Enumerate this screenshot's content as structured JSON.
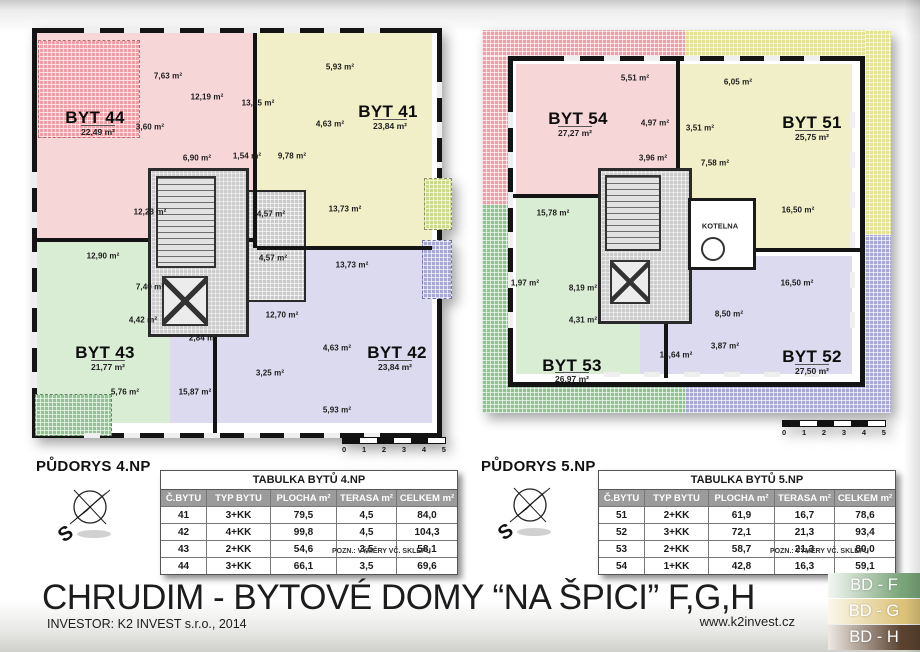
{
  "plans": [
    {
      "title": "PŮDORYS 4.NP",
      "apartments": [
        {
          "name": "BYT 44",
          "area": "22,49 m²"
        },
        {
          "name": "BYT 41",
          "area": "23,84 m²"
        },
        {
          "name": "BYT 43",
          "area": "21,77 m²"
        },
        {
          "name": "BYT 42",
          "area": "23,84 m²"
        }
      ],
      "rooms": [
        "7,63 m²",
        "12,19 m²",
        "13,25 m²",
        "5,93 m²",
        "4,63 m²",
        "3,60 m²",
        "6,90 m²",
        "1,54 m²",
        "9,78 m²",
        "12,23 m²",
        "4,57 m²",
        "13,73 m²",
        "12,90 m²",
        "13,73 m²",
        "4,57 m²",
        "7,40 m²",
        "4,42 m²",
        "12,70 m²",
        "2,84 m²",
        "4,63 m²",
        "3,25 m²",
        "5,76 m²",
        "15,87 m²",
        "5,93 m²"
      ]
    },
    {
      "title": "PŮDORYS 5.NP",
      "apartments": [
        {
          "name": "BYT 54",
          "area": "27,27 m²"
        },
        {
          "name": "BYT 51",
          "area": "25,75 m²"
        },
        {
          "name": "BYT 53",
          "area": "26,97 m²"
        },
        {
          "name": "BYT 52",
          "area": "27,50 m²"
        }
      ],
      "rooms": [
        "5,51 m²",
        "6,05 m²",
        "4,97 m²",
        "3,96 m²",
        "3,51 m²",
        "7,58 m²",
        "15,78 m²",
        "16,50 m²",
        "1,97 m²",
        "8,19 m²",
        "4,31 m²",
        "16,50 m²",
        "8,50 m²",
        "13,64 m²",
        "3,87 m²"
      ],
      "boiler_room": "KOTELNA"
    }
  ],
  "compass": {
    "south": "S"
  },
  "scalebar": [
    "0",
    "1",
    "2",
    "3",
    "4",
    "5"
  ],
  "tables": [
    {
      "title": "TABULKA BYTŮ 4.NP",
      "headers": [
        "Č.BYTU",
        "TYP BYTU",
        "PLOCHA m²",
        "TERASA m²",
        "CELKEM m²"
      ],
      "rows": [
        [
          "41",
          "3+KK",
          "79,5",
          "4,5",
          "84,0"
        ],
        [
          "42",
          "4+KK",
          "99,8",
          "4,5",
          "104,3"
        ],
        [
          "43",
          "2+KK",
          "54,6",
          "3,5",
          "58,1"
        ],
        [
          "44",
          "3+KK",
          "66,1",
          "3,5",
          "69,6"
        ]
      ],
      "note": "POZN.: VÝMĚRY VČ. SKLEPU"
    },
    {
      "title": "TABULKA BYTŮ 5.NP",
      "headers": [
        "Č.BYTU",
        "TYP BYTU",
        "PLOCHA m²",
        "TERASA m²",
        "CELKEM m²"
      ],
      "rows": [
        [
          "51",
          "2+KK",
          "61,9",
          "16,7",
          "78,6"
        ],
        [
          "52",
          "3+KK",
          "72,1",
          "21,3",
          "93,4"
        ],
        [
          "53",
          "2+KK",
          "58,7",
          "21,3",
          "80,0"
        ],
        [
          "54",
          "1+KK",
          "42,8",
          "16,3",
          "59,1"
        ]
      ],
      "note": "POZN.: VÝMĚRY VČ. SKLEPU"
    }
  ],
  "footer": {
    "title": "CHRUDIM - BYTOVÉ DOMY “NA ŠPICI” F,G,H",
    "investor": "INVESTOR: K2 INVEST s.r.o., 2014",
    "url": "www.k2invest.cz"
  },
  "legend": {
    "items": [
      {
        "label": "BD - F",
        "color": "#79a479"
      },
      {
        "label": "BD - G",
        "color": "#dcc379"
      },
      {
        "label": "BD - H",
        "color": "#5a422f"
      }
    ]
  },
  "colors": {
    "apartment_pink": "#f7d6d8",
    "apartment_yellow": "#f0efc7",
    "apartment_green": "#d9ecd4",
    "apartment_lavender": "#dbdaee",
    "terrace_pink": "#ef9fa5",
    "terrace_yellow": "#e2e292",
    "terrace_green": "#8fc48f",
    "terrace_lavender": "#a9a8d4",
    "wall": "#141414"
  }
}
